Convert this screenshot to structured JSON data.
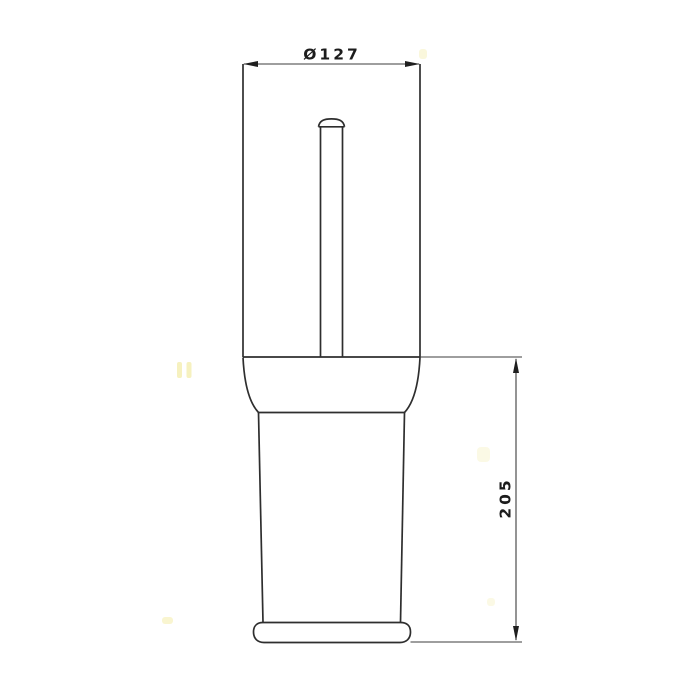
{
  "drawing": {
    "kind": "technical-dimension-drawing",
    "object": "toilet-brush-holder-front-view",
    "dimensions": {
      "diameter": {
        "label": "Ø127",
        "value": 127
      },
      "height": {
        "label": "205",
        "value": 205
      }
    },
    "colors": {
      "background": "#ffffff",
      "object_line": "#2e2e2e",
      "dimension_line": "#3c3c3c",
      "text": "#1c1c1c",
      "watermark": "#efe58a"
    }
  }
}
